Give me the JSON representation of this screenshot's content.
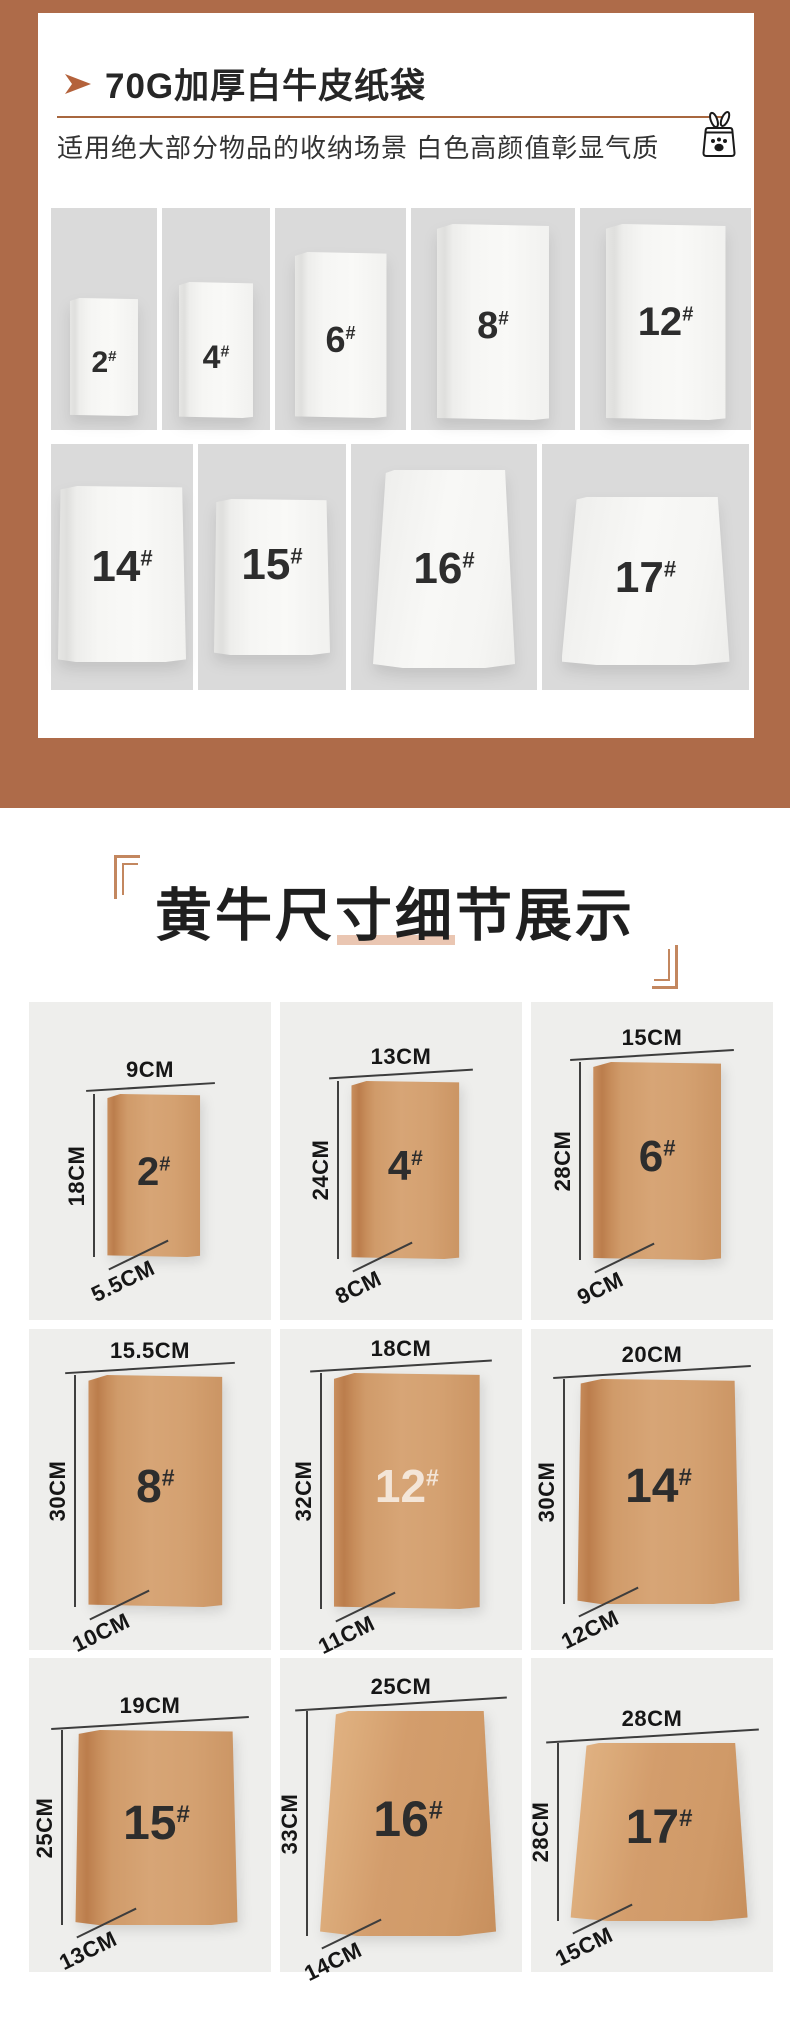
{
  "colors": {
    "frame": "#ae6b49",
    "accent": "#a8673f",
    "arrow": "#b4623b",
    "bracket": "#c3875f",
    "underline": "#eac6b2",
    "white_cell_bg": "#dadada",
    "kraft_cell_bg": "#eeeeec",
    "kraft_bag": "#d09c6c"
  },
  "hero": {
    "title": "70G加厚白牛皮纸袋",
    "subtitle": "适用绝大部分物品的收纳场景 白色高颜值彰显气质",
    "arrow_icon": "arrow-right",
    "bag_icon": "pet-food-bag",
    "hash": "#",
    "row1": [
      {
        "num": "2"
      },
      {
        "num": "4"
      },
      {
        "num": "6"
      },
      {
        "num": "8"
      },
      {
        "num": "12"
      }
    ],
    "row2": [
      {
        "num": "14"
      },
      {
        "num": "15"
      },
      {
        "num": "16"
      },
      {
        "num": "17"
      }
    ]
  },
  "size_section": {
    "title": "黄牛尺寸细节展示",
    "hash": "#",
    "bags": [
      {
        "num": "2",
        "width_cm": "9CM",
        "height_cm": "18CM",
        "bottom_cm": "5.5CM"
      },
      {
        "num": "4",
        "width_cm": "13CM",
        "height_cm": "24CM",
        "bottom_cm": "8CM"
      },
      {
        "num": "6",
        "width_cm": "15CM",
        "height_cm": "28CM",
        "bottom_cm": "9CM"
      },
      {
        "num": "8",
        "width_cm": "15.5CM",
        "height_cm": "30CM",
        "bottom_cm": "10CM"
      },
      {
        "num": "12",
        "width_cm": "18CM",
        "height_cm": "32CM",
        "bottom_cm": "11CM"
      },
      {
        "num": "14",
        "width_cm": "20CM",
        "height_cm": "30CM",
        "bottom_cm": "12CM"
      },
      {
        "num": "15",
        "width_cm": "19CM",
        "height_cm": "25CM",
        "bottom_cm": "13CM"
      },
      {
        "num": "16",
        "width_cm": "25CM",
        "height_cm": "33CM",
        "bottom_cm": "14CM"
      },
      {
        "num": "17",
        "width_cm": "28CM",
        "height_cm": "28CM",
        "bottom_cm": "15CM"
      }
    ]
  }
}
